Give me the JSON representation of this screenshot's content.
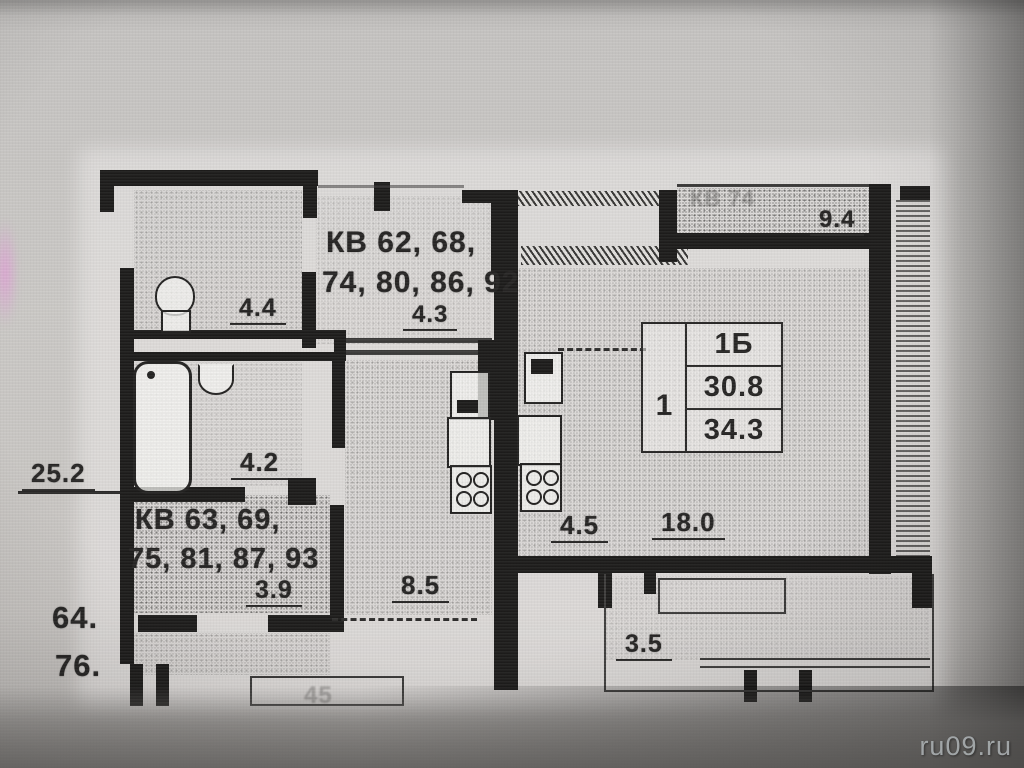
{
  "photo": {
    "watermark": "ru09.ru"
  },
  "stamp": {
    "unit": "1",
    "type": "1Б",
    "living_area": "30.8",
    "total_area": "34.3"
  },
  "labels": {
    "apt_top_line1": "КВ 62, 68,",
    "apt_top_line2": "74, 80, 86, 92",
    "apt_bottom_line1": "КВ 63, 69,",
    "apt_bottom_line2": "75, 81, 87, 93",
    "floor_nums_line1": "64.",
    "floor_nums_line2": "76.",
    "dim_total": "25.2",
    "dim_room_44": "4.4",
    "dim_hall_43": "4.3",
    "dim_room_42": "4.2",
    "dim_hall_39": "3.9",
    "dim_corridor_85": "8.5",
    "dim_kitchen_45": "4.5",
    "dim_living_18": "18.0",
    "dim_balcony_94": "9.4",
    "dim_balcony_35": "3.5",
    "faint_apt": "КВ 74",
    "faint_bottom": "45"
  },
  "colors": {
    "ink": "#222120",
    "photo_bg": "#c8c6c3",
    "watermark_text": "#a9aeb0",
    "smudge": "#ee86e0"
  }
}
